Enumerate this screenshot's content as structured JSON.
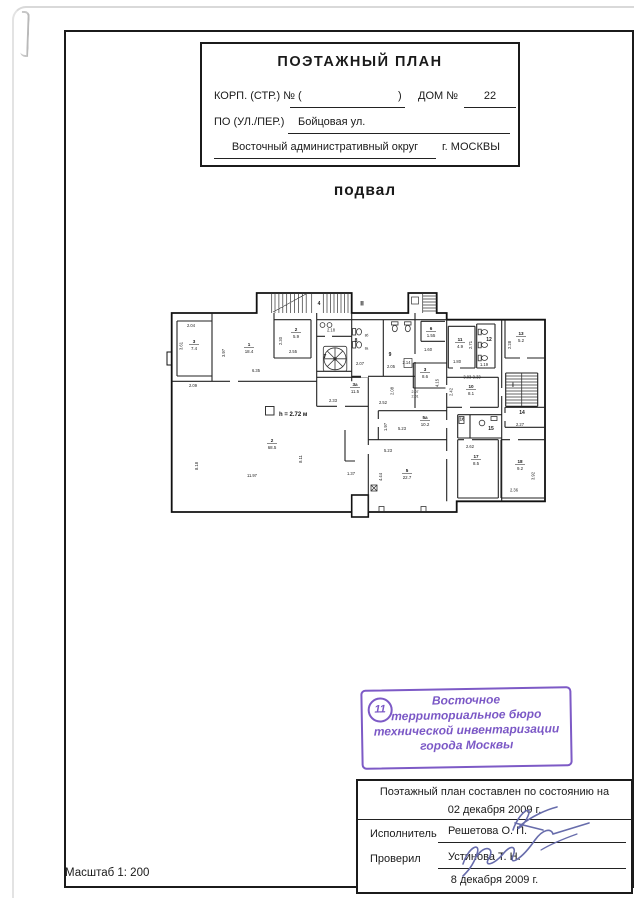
{
  "header": {
    "title": "ПОЭТАЖНЫЙ ПЛАН",
    "korp_label": "КОРП. (СТР.) №",
    "paren_open": "(",
    "paren_close": ")",
    "dom_label": "ДОМ №",
    "dom_value": "22",
    "street_label": "ПО (УЛ./ПЕР.)",
    "street_value": "Бойцовая ул.",
    "district": "Восточный административный округ",
    "city": "г. МОСКВЫ"
  },
  "floor_title": "подвал",
  "plan": {
    "height_note": "h = 2.72 м",
    "rooms": [
      {
        "n": "3",
        "a": "7.4",
        "x": 29,
        "y": 56
      },
      {
        "n": "1",
        "a": "18.4",
        "x": 84,
        "y": 59
      },
      {
        "n": "2",
        "a": "5.9",
        "x": 131,
        "y": 44
      },
      {
        "n": "6",
        "a": "1.55",
        "x": 266,
        "y": 43
      },
      {
        "n": "11",
        "a": "4.9",
        "x": 295,
        "y": 54
      },
      {
        "n": "13",
        "a": "5.2",
        "x": 356,
        "y": 48
      },
      {
        "n": "3",
        "a": "8.6",
        "x": 260,
        "y": 84
      },
      {
        "n": "10",
        "a": "8.1",
        "x": 306,
        "y": 101
      },
      {
        "n": "3а",
        "a": "11.5",
        "x": 190,
        "y": 99
      },
      {
        "n": "5а",
        "a": "10.2",
        "x": 260,
        "y": 132
      },
      {
        "n": "5",
        "a": "22.7",
        "x": 242,
        "y": 185
      },
      {
        "n": "2",
        "a": "68.5",
        "x": 107,
        "y": 155
      },
      {
        "n": "17",
        "a": "8.5",
        "x": 311,
        "y": 171
      },
      {
        "n": "18",
        "a": "9.2",
        "x": 355,
        "y": 176
      }
    ],
    "labels": [
      {
        "t": "2.04",
        "x": 26,
        "y": 39
      },
      {
        "t": "2.09",
        "x": 28,
        "y": 99
      },
      {
        "t": "6.35",
        "x": 91,
        "y": 84
      },
      {
        "t": "2.55",
        "x": 128,
        "y": 65
      },
      {
        "t": "2.18",
        "x": 166,
        "y": 43.5
      },
      {
        "t": "2.07",
        "x": 195,
        "y": 77
      },
      {
        "t": "2.05",
        "x": 226,
        "y": 80
      },
      {
        "t": "2.14",
        "x": 241.5,
        "y": 76
      },
      {
        "t": "1.60",
        "x": 263,
        "y": 63
      },
      {
        "t": "1.80",
        "x": 292,
        "y": 75
      },
      {
        "t": "1.19",
        "x": 319,
        "y": 78
      },
      {
        "t": "3.03-3.33",
        "x": 307,
        "y": 90.5
      },
      {
        "t": "2.33",
        "x": 168,
        "y": 114
      },
      {
        "t": "2.52",
        "x": 218,
        "y": 116
      },
      {
        "t": "2.07",
        "x": 250,
        "y": 105,
        "s": 3.6
      },
      {
        "t": "2.01",
        "x": 250,
        "y": 109.5,
        "s": 3.6
      },
      {
        "t": "5.23",
        "x": 237,
        "y": 142
      },
      {
        "t": "5.23",
        "x": 223,
        "y": 164
      },
      {
        "t": "11.97",
        "x": 87,
        "y": 189
      },
      {
        "t": "1.37",
        "x": 186,
        "y": 187
      },
      {
        "t": "2.27",
        "x": 355,
        "y": 138
      },
      {
        "t": "2.36",
        "x": 349,
        "y": 203.5
      },
      {
        "t": "2.62",
        "x": 305,
        "y": 160
      },
      {
        "t": "3.61",
        "x": 17.5,
        "y": 58,
        "r": 1
      },
      {
        "t": "3.97",
        "x": 60,
        "y": 65,
        "r": 1
      },
      {
        "t": "2.30",
        "x": 117,
        "y": 53,
        "r": 1
      },
      {
        "t": "8.18",
        "x": 33,
        "y": 178,
        "r": 1
      },
      {
        "t": "8.11",
        "x": 137,
        "y": 171,
        "r": 1
      },
      {
        "t": "2.08",
        "x": 228.5,
        "y": 103,
        "r": 1
      },
      {
        "t": "4.15",
        "x": 273.5,
        "y": 95,
        "r": 1
      },
      {
        "t": "2.71",
        "x": 307,
        "y": 57,
        "r": 1
      },
      {
        "t": "2.28",
        "x": 346,
        "y": 57,
        "r": 1
      },
      {
        "t": "2.42",
        "x": 287.5,
        "y": 104,
        "r": 1
      },
      {
        "t": "1.97",
        "x": 222,
        "y": 139,
        "r": 1
      },
      {
        "t": "4.44",
        "x": 217,
        "y": 189,
        "r": 1
      },
      {
        "t": "3.92",
        "x": 369.5,
        "y": 188,
        "r": 1
      },
      {
        "t": "7",
        "x": 160,
        "y": 70,
        "s": 5,
        "b": 1
      },
      {
        "t": "8",
        "x": 191,
        "y": 54,
        "s": 5,
        "b": 1
      },
      {
        "t": "9",
        "x": 225,
        "y": 68,
        "s": 5,
        "b": 1
      },
      {
        "t": "12",
        "x": 324,
        "y": 53,
        "s": 5,
        "b": 1
      },
      {
        "t": "14",
        "x": 357,
        "y": 126,
        "s": 5,
        "b": 1
      },
      {
        "t": "15",
        "x": 326,
        "y": 142,
        "s": 5,
        "b": 1
      },
      {
        "t": "16",
        "x": 297,
        "y": 132.5,
        "s": 4.2,
        "b": 1
      },
      {
        "t": "8б",
        "x": 201.5,
        "y": 48.5,
        "s": 3.2
      },
      {
        "t": "8а",
        "x": 201.5,
        "y": 61.5,
        "s": 3.2
      },
      {
        "t": "4",
        "x": 154,
        "y": 17,
        "s": 5,
        "b": 1
      },
      {
        "t": "II",
        "x": 197,
        "y": 17.5,
        "s": 6.5,
        "b": 1
      },
      {
        "t": "I",
        "x": 348,
        "y": 99,
        "s": 6,
        "b": 1
      }
    ]
  },
  "stamp": {
    "number": "11",
    "lines": [
      "Восточное",
      "территориальное бюро",
      "технической инвентаризации",
      "города Москвы"
    ],
    "color": "#7d5ac6"
  },
  "footer_table": {
    "line1": "Поэтажный план составлен по состоянию на",
    "date1": "02 декабря 2009 г.",
    "executor_label": "Исполнитель",
    "executor_name": "Решетова О. П.",
    "checker_label": "Проверил",
    "checker_name": "Устинова Т. Н.",
    "date2": "8 декабря 2009 г."
  },
  "scale_label": "Масштаб 1: 200"
}
